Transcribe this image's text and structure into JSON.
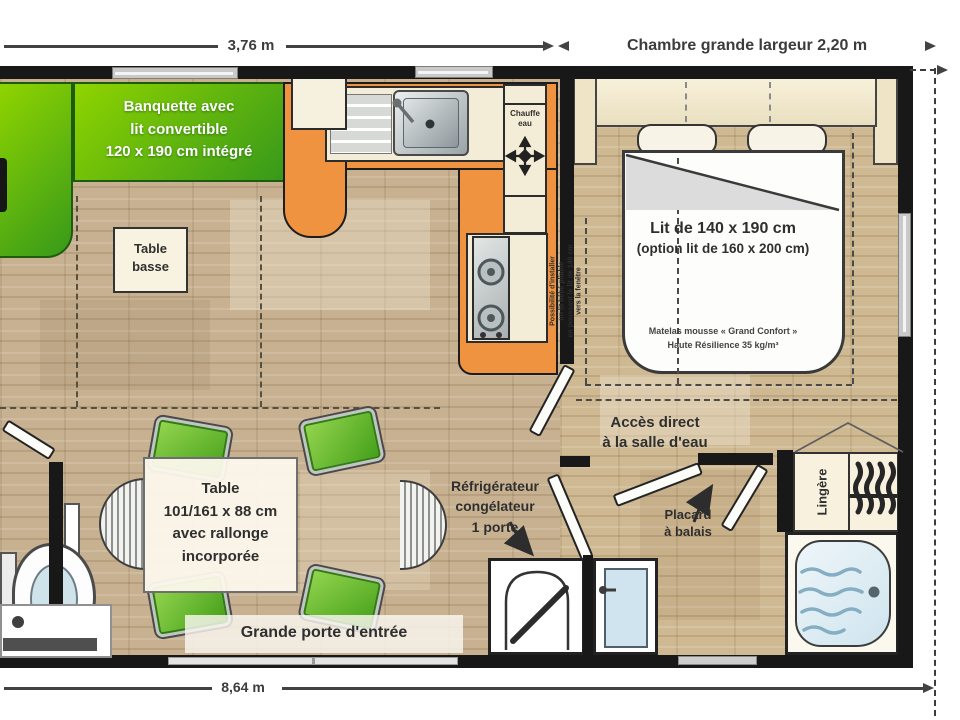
{
  "dims": {
    "living_width": "3,76 m",
    "bedroom_width": "Chambre grande largeur 2,20 m",
    "total_length": "8,64 m"
  },
  "living": {
    "banquette": {
      "l1": "Banquette avec",
      "l2": "lit convertible",
      "l3": "120 x 190 cm intégré"
    },
    "coffee_table": {
      "l1": "Table",
      "l2": "basse"
    },
    "dining_table": {
      "l1": "Table",
      "l2": "101/161 x 88 cm",
      "l3": "avec rallonge",
      "l4": "incorporée"
    },
    "entry_door": "Grande porte d'entrée"
  },
  "kitchen": {
    "water_heater": {
      "l1": "Chauffe",
      "l2": "eau"
    },
    "fridge": {
      "l1": "Réfrigérateur",
      "l2": "congélateur",
      "l3": "1 porte"
    }
  },
  "bedroom": {
    "bed": {
      "l1": "Lit de 140 x 190 cm",
      "l2": "(option lit de 160 x 200 cm)"
    },
    "mattress": {
      "l1": "Matelas mousse « Grand Confort »",
      "l2": "Haute Résilience 35 kg/m³"
    },
    "baby_bed_note": {
      "l1": "Possibilité d'installer",
      "l2": "un lit bébé pliable",
      "l3": "en poussant le lit de 140 cm",
      "l4": "vers la fenêtre"
    }
  },
  "bathroom": {
    "access": {
      "l1": "Accès direct",
      "l2": "à la salle d'eau"
    },
    "broom_closet": {
      "l1": "Placard",
      "l2": "à balais"
    },
    "linen_cupboard": "Lingère"
  },
  "colors": {
    "wall": "#1a1a1a",
    "banquette_green": "#4da41e",
    "kitchen_orange": "#ef9340",
    "chair_green": "#5fb32b",
    "floor_wood": "#c8b392",
    "water_blue": "#cfe4ee",
    "cream": "#f3ecd7"
  },
  "icons": {
    "water_heater_valve": "cross-valve",
    "towel_radiator": "wavy-bars",
    "shower_drain": "dot",
    "gas_hob": "two-burners"
  }
}
